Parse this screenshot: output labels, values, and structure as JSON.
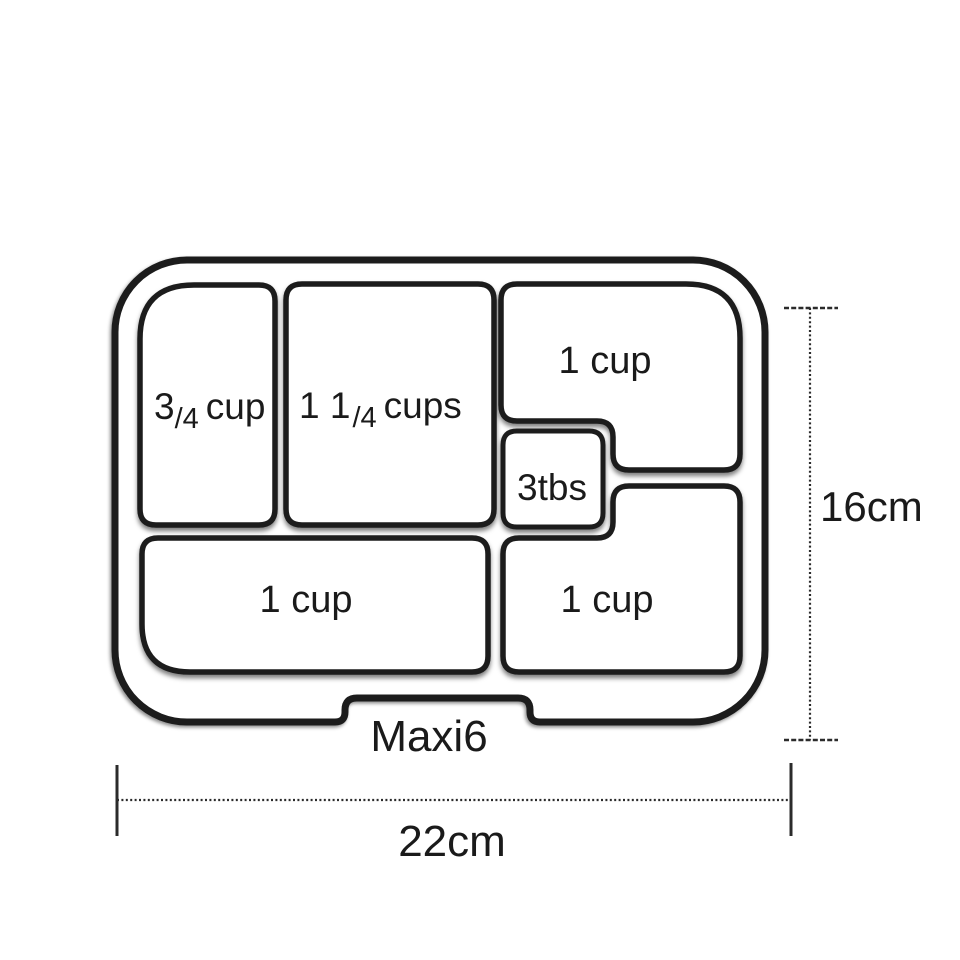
{
  "tray": {
    "name": "Maxi6",
    "compartments": [
      {
        "position": "top-left",
        "whole": "3",
        "frac": "/4",
        "unit": "cup"
      },
      {
        "position": "top-middle",
        "whole": "1 1",
        "frac": "/4",
        "unit": "cups"
      },
      {
        "position": "top-right",
        "label": "1 cup"
      },
      {
        "position": "middle-small",
        "label": "3tbs"
      },
      {
        "position": "bottom-left",
        "label": "1 cup"
      },
      {
        "position": "bottom-right",
        "label": "1 cup"
      }
    ]
  },
  "dimensions": {
    "height_label": "16cm",
    "width_label": "22cm"
  },
  "colors": {
    "line": "#1b1b1b",
    "background": "#ffffff"
  }
}
